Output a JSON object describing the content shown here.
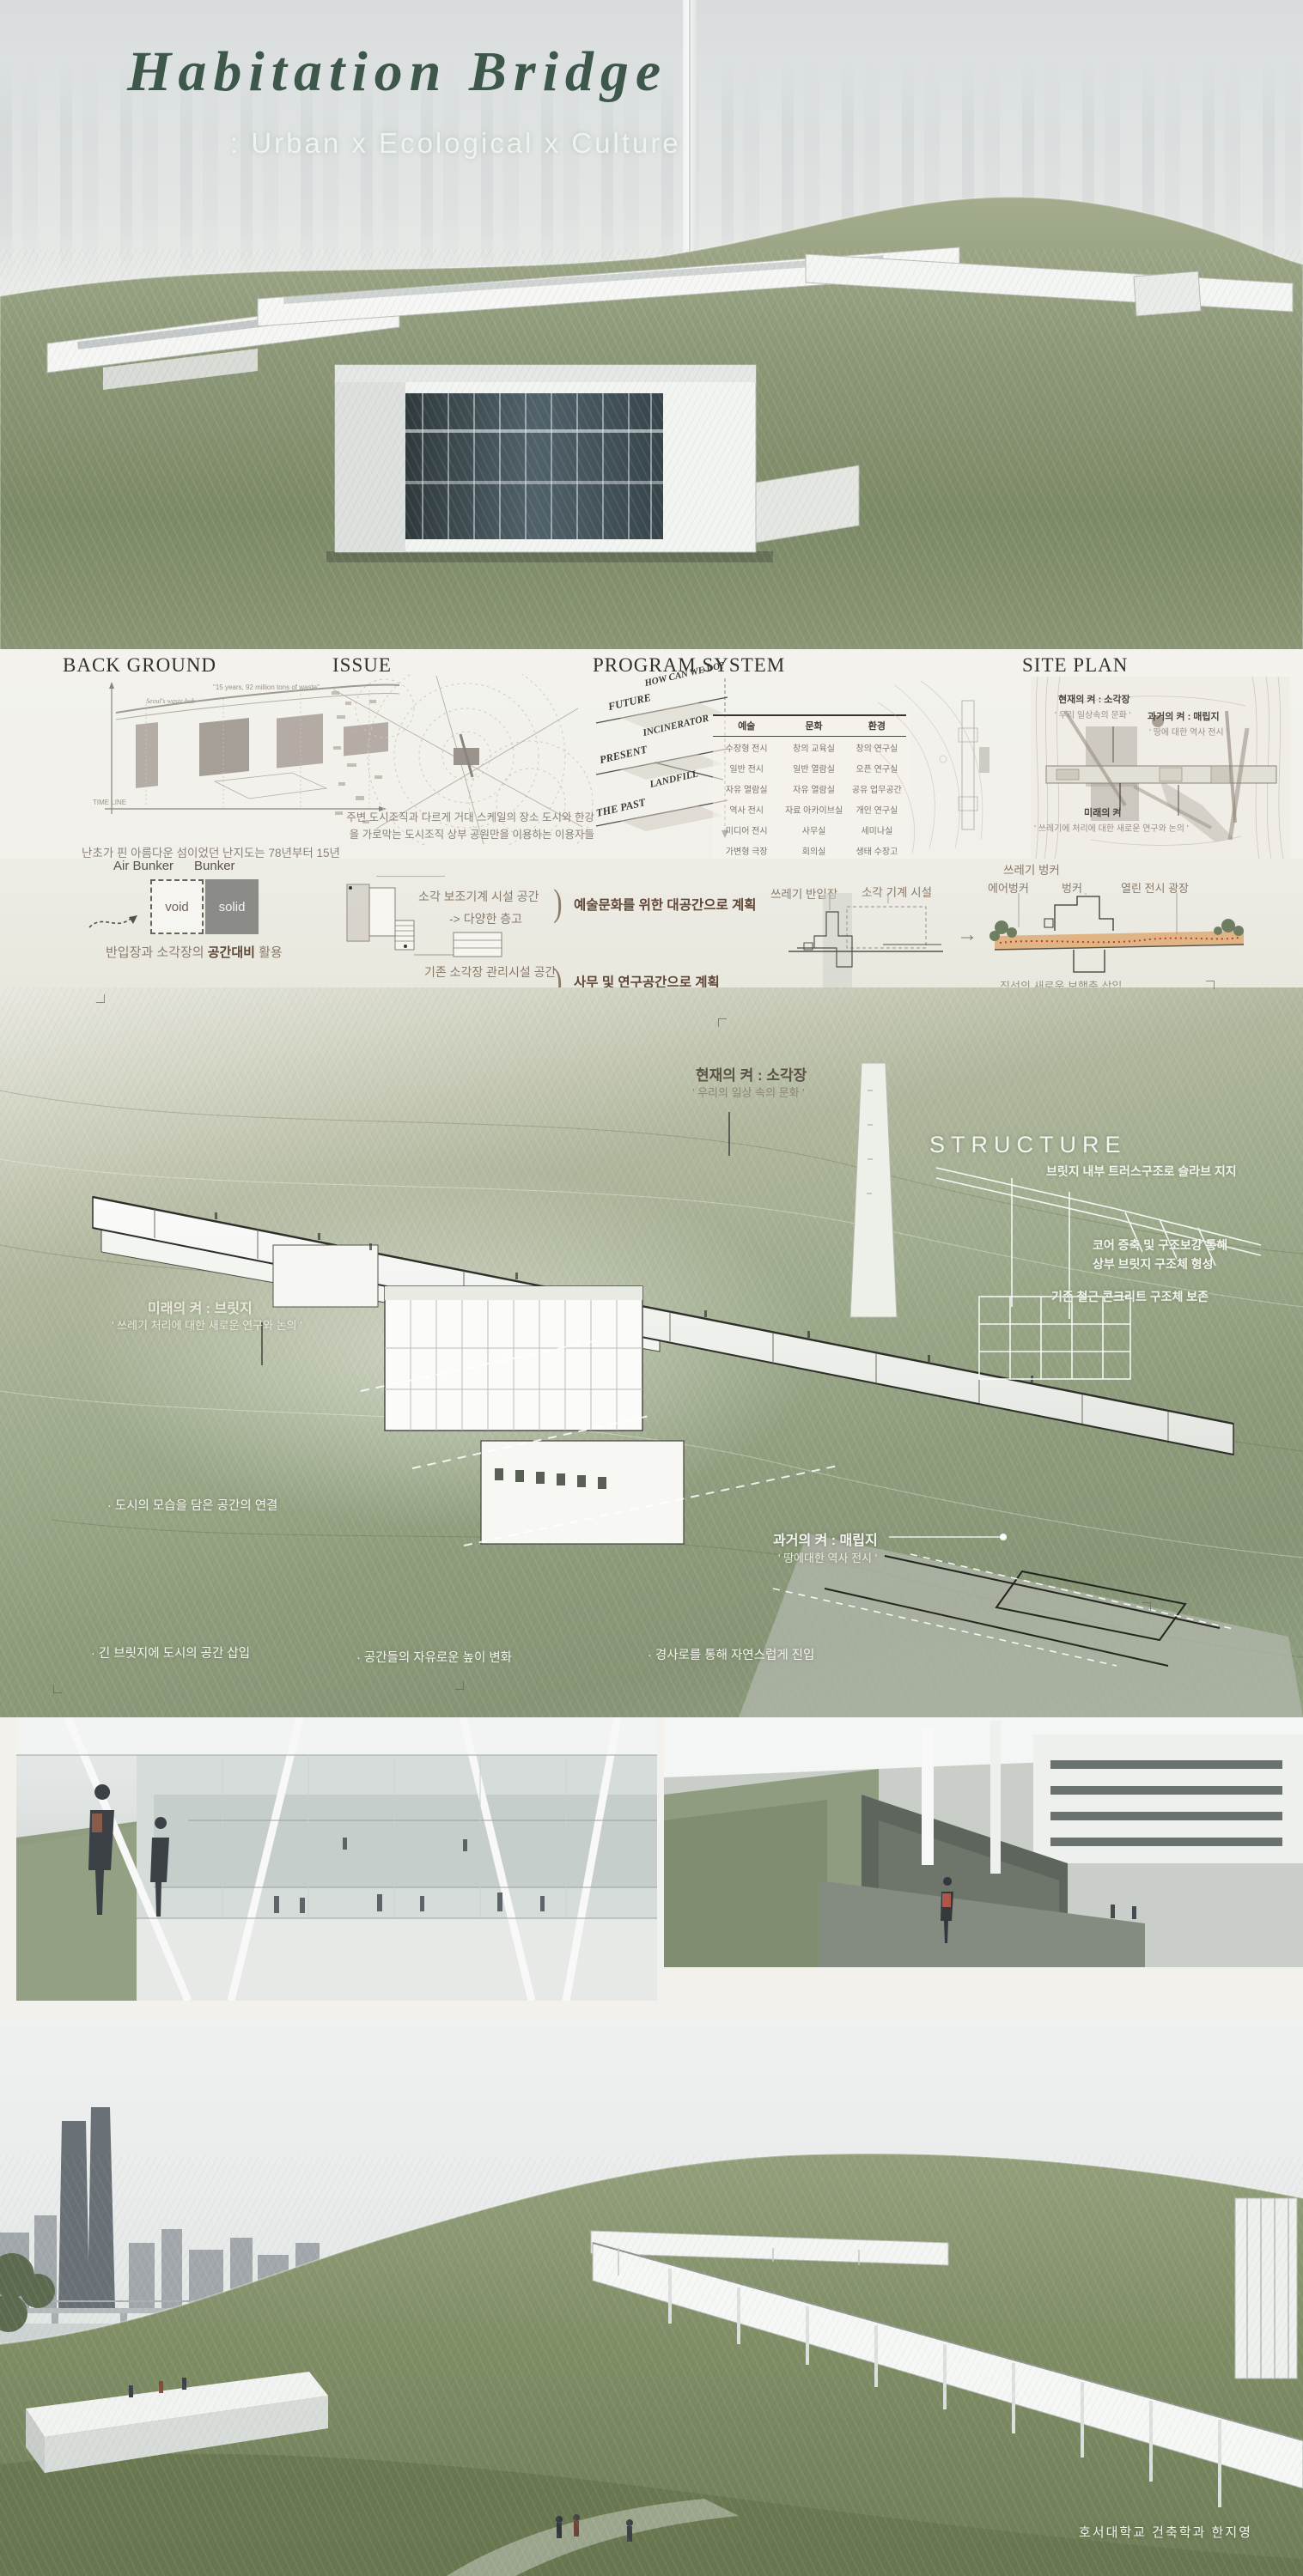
{
  "header": {
    "title": "Habitation  Bridge",
    "subtitle": ": Urban x Ecological x Culture"
  },
  "analysis": {
    "background": {
      "heading": "BACK GROUND",
      "labels": {
        "waste_hub": "Seoul's waste hub",
        "quote": "\"15 years, 92 million tons of waste\"",
        "timeline": "TIME LINE"
      },
      "paragraph": "난초가 핀 아름다운 섬이었던 난지도는 78년부터 15년간\n서울의 모든 생활쓰레기와 건축 쓰레기 수십만톤이 매립\n되어 98M의 거대 인공 쓰레기산이 형성되었다. 1998년\n매립지 안정화 사업 후 공원화가 되어 현재의 난지도가 되었다."
    },
    "issue": {
      "heading": "ISSUE",
      "paragraph": "주변 도시조직과 다르게  거대 스케일의 장소\n도시와 한강을  가로막는 도시조직\n상부 공원만을 이용하는  이용자들"
    },
    "program": {
      "heading": "PROGRAM SYSTEM",
      "axis_labels": [
        "HOW CAN WE DO?",
        "FUTURE",
        "INCINERATOR",
        "PRESENT",
        "LANDFILL",
        "THE PAST"
      ],
      "table": {
        "headers": [
          "예술",
          "문화",
          "환경"
        ],
        "rows": [
          [
            "수장형 전시",
            "창의 교육실",
            "창의 연구실"
          ],
          [
            "일반 전시",
            "일반 열람실",
            "오픈 연구실"
          ],
          [
            "자유 열람실",
            "자유 열람실",
            "공유 업무공간"
          ],
          [
            "역사 전시",
            "자료 아카이브실",
            "개인 연구실"
          ],
          [
            "미디어 전시",
            "사무실",
            "세미나실"
          ],
          [
            "가변형 극장",
            "회의실",
            "생태 수장고"
          ],
          [
            "아티스트 창작실",
            "북카페",
            "국제회의실"
          ],
          [
            "창작 스튜디오",
            "북 라운지",
            "환경관리기구"
          ]
        ]
      }
    },
    "siteplan": {
      "heading": "SITE PLAN",
      "present": {
        "title": "현재의 켜 : 소각장",
        "sub": "' 우리 일상속의 문화 '"
      },
      "past": {
        "title": "과거의 켜 : 매립지",
        "sub": "' 땅에 대한 역사 전시 '"
      },
      "future": {
        "title": "미래의 켜",
        "sub": "' 쓰레기에 처리에 대한 새로운 연구와 논의 '"
      }
    }
  },
  "concept": {
    "air_bunker": "Air Bunker",
    "bunker": "Bunker",
    "void": "void",
    "solid": "solid",
    "contrast": {
      "pre": "반입장과 소각장의 ",
      "bold": "공간대비",
      "post": " 활용"
    },
    "aux_space": {
      "line1": "소각 보조기계 시설 공간",
      "line2": "-> 다양한 층고",
      "result": "예술문화를 위한 대공간으로 계획"
    },
    "mgmt_space": {
      "line1": "기존 소각장 관리시설 공간",
      "line2": "-> 일정한 층고",
      "result": "사무 및 연구공간으로 계획"
    },
    "section": {
      "waste_bunker": "쓰레기 벙커",
      "waste_intake": "쓰레기 반입장",
      "machine": "소각 기계 시설",
      "existing_caption": "기존 소각장 단면",
      "arrow": "→",
      "air_bunker": "에어벙커",
      "bunker": "벙커",
      "plaza": "열린 전시 광장",
      "axis": "직선의 새로운 보행축 삽입",
      "through": "소각장의 단면을 관통"
    },
    "approach": "북측 도시로부터의\n접근",
    "approach_arrow": "◄ · · · · ·",
    "plaza_pull": {
      "pre": "소각장의 ",
      "bold": "열린 중앙광장",
      "post": "으로 외부 끌어당김"
    }
  },
  "axon": {
    "present_layer": {
      "title": "현재의 켜 : 소각장",
      "sub": "' 우리의 일상 속의 문화 '"
    },
    "structure": {
      "heading": "STRUCTURE",
      "note1": "브릿지 내부 트러스구조로 슬라브 지지",
      "note2": "코어 증축 및 구조보강 통해\n상부 브릿지 구조체 형성",
      "note3": "기존 철근 콘크리트 구조체 보존"
    },
    "future_layer": {
      "title": "미래의 켜 : 브릿지",
      "sub": "' 쓰레기 처리에 대한 새로운 연구와 논의 '"
    },
    "past_layer": {
      "title": "과거의 켜 : 매립지",
      "sub": "' 땅에대한 역사 전시 '"
    },
    "bullet_connect": "· 도시의 모습을 담은 공간의 연결",
    "bullet_insert": "· 긴 브릿지에 도시의 공간 삽입",
    "bullet_height": "· 공간들의 자유로운 높이 변화",
    "bullet_ramp": "· 경사로를 통해 자연스럽게 진입"
  },
  "footer": {
    "credit": "호서대학교 건축학과   한지영"
  },
  "colors": {
    "title_green": "#3d574b",
    "accent_brown": "#5f4636",
    "text_brown": "#8a7a6a",
    "band_orange": "#dca76f",
    "dot_red": "#c23b22"
  }
}
